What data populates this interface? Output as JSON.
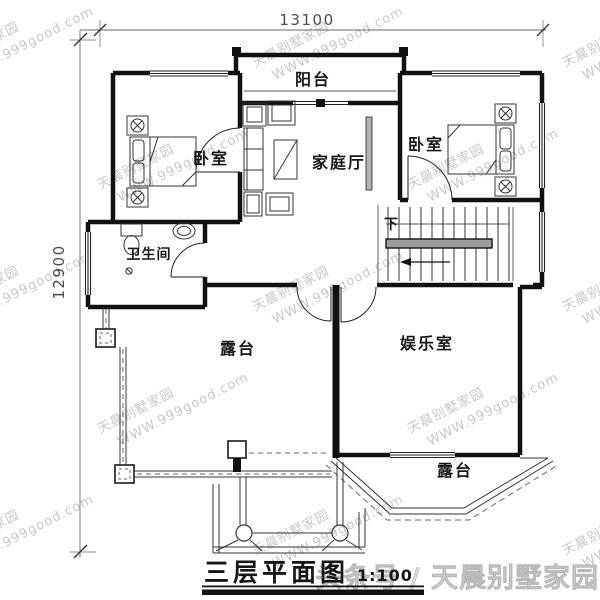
{
  "plan": {
    "dimension_top": "13100",
    "dimension_left": "12900",
    "rooms": {
      "balcony": "阳台",
      "bedroom_left": "卧室",
      "family_hall": "家庭厅",
      "bedroom_right": "卧室",
      "bathroom": "卫生间",
      "terrace": "露台",
      "entertainment_room": "娱乐室",
      "terrace_bay": "露台",
      "stair_direction": "下"
    },
    "title": "三层平面图",
    "title_scale": "1:100"
  },
  "watermark": {
    "brand": "天晨别墅家园",
    "url": "WWW.999good.com"
  },
  "caption": "头条号 / 天晨别墅家园",
  "colors": {
    "ink": "#161616",
    "dimension_text": "#4a4a4a",
    "watermark": "#c7c7c7",
    "caption": "#dcdcdc",
    "handrail_gray": "#9c9c9c"
  }
}
